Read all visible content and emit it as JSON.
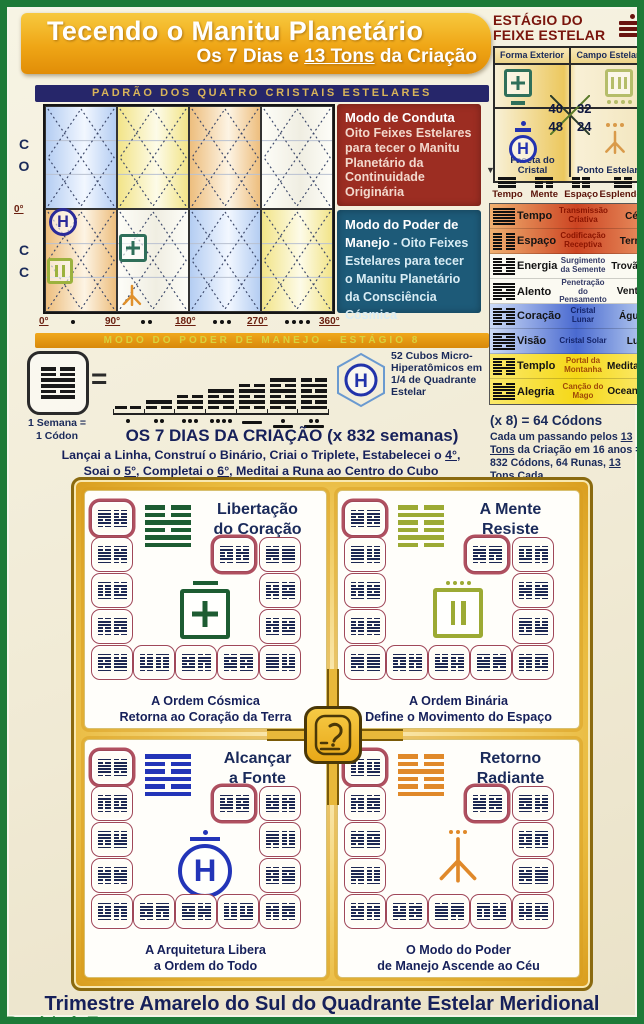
{
  "colors": {
    "frame_green": "#1d7a38",
    "banner_orange": "#efa616",
    "navy": "#16205a",
    "band_navy": "#26266a",
    "band_gold_text": "#d8b45a",
    "conduct_red": "#9c2d22",
    "power_blue": "#1d5a78",
    "gold_frame": "#e8b83a",
    "title_red": "#7a150d",
    "tile_border": "#a04858",
    "hexagram_navy": "#1c2752"
  },
  "icons": {
    "h_glyph": "H"
  },
  "header": {
    "title": "Tecendo o Manitu Planetário",
    "subtitle_pre": "Os 7 Dias e ",
    "subtitle_u": "13 Tons",
    "subtitle_post": " da Criação"
  },
  "stage_panel": {
    "title_line1": "ESTÁGIO DO",
    "title_line2": "FEIXE ESTELAR",
    "label_top_left": "Forma Exterior",
    "label_top_right": "Campo Estelar",
    "label_bottom_left": "Faceta do Cristal",
    "label_bottom_right": "Ponto Estelar",
    "num_top_left": "40",
    "num_top_right": "32",
    "num_bottom_left": "48",
    "num_bottom_right": "24",
    "symbol_colors": {
      "forma_exterior": "#2f6f5a",
      "campo_estelar": "#b5bd6a",
      "faceta_do_cristal": "#2433b0",
      "ponto_estelar": "#d99a4a"
    }
  },
  "pattern_chart": {
    "band_title": "PADRÃO DOS QUATRO CRISTAIS ESTELARES",
    "left_top_lines": [
      "C",
      "O"
    ],
    "left_zero": "0°",
    "left_bottom_lines": [
      "C",
      "C"
    ],
    "row1_cells": [
      "blue",
      "yellow",
      "orange",
      "white"
    ],
    "row2_cells": [
      "orange",
      "white",
      "blue",
      "yellow"
    ],
    "axis_labels": [
      "0°",
      "90°",
      "180°",
      "270°",
      "360°"
    ],
    "axis_dot_groups": [
      1,
      2,
      3,
      4
    ],
    "bottom_band": "MODO DO PODER DE MANEJO  -  ESTÁGIO 8",
    "symbol_colors": {
      "circle_h": "#2a2a99",
      "square_bars": "#9cb23e",
      "square_plus": "#2f6f5a",
      "trident": "#e0912c"
    }
  },
  "mode_boxes": {
    "conduct": {
      "heading": "Modo de Conduta",
      "body": "Oito Feixes Estelares para tecer o Manitu Planetário da Continuidade Originária"
    },
    "power": {
      "heading": "Modo do Poder de Manejo",
      "body": " - Oito Feixes Estelares para tecer o Manitu Planetário da Consciência Cósmica"
    }
  },
  "codon_table": {
    "headers": [
      "Tempo",
      "Mente",
      "Espaço",
      "Esplendor"
    ],
    "header_trigrams": [
      "sss",
      "sbb",
      "bbb",
      "bss"
    ],
    "rows": [
      {
        "hexagram": "ssssss",
        "name": "Tempo",
        "desc": "Transmissão Criativa",
        "element": "Céu",
        "theme": "red"
      },
      {
        "hexagram": "bbbbbb",
        "name": "Espaço",
        "desc": "Codificação Receptiva",
        "element": "Terra",
        "theme": "red"
      },
      {
        "hexagram": "bbsbbs",
        "name": "Energia",
        "desc": "Surgimento da Semente",
        "element": "Trovão",
        "theme": "white"
      },
      {
        "hexagram": "ssbssb",
        "name": "Alento",
        "desc": "Penetração do Pensamento",
        "element": "Vento",
        "theme": "white"
      },
      {
        "hexagram": "bsbbsb",
        "name": "Coração",
        "desc": "Cristal Lunar",
        "element": "Água",
        "theme": "blue"
      },
      {
        "hexagram": "sbssbs",
        "name": "Visão",
        "desc": "Cristal Solar",
        "element": "Luz",
        "theme": "blue"
      },
      {
        "hexagram": "sbbsbb",
        "name": "Templo",
        "desc": "Portal da Montanha",
        "element": "Meditação",
        "theme": "yellow"
      },
      {
        "hexagram": "bssbss",
        "name": "Alegria",
        "desc": "Canção do Mago",
        "element": "Oceano",
        "theme": "yellow"
      }
    ],
    "total_line": "(x 8) = 64 Códons",
    "note_p1": "Cada um passando pelos ",
    "note_u1": "13 Tons",
    "note_p2": " da Criação em 16 anos = 832 Códons, 64 Runas, ",
    "note_u2": "13 Tons",
    "note_p3": " Cada"
  },
  "creation_week": {
    "equation_label_line1": "1 Semana =",
    "equation_label_line2": "1 Códon",
    "codon_hexagram": "bbssbs",
    "equals_sign": "=",
    "day_stacks": [
      1,
      2,
      3,
      4,
      5,
      6,
      6
    ],
    "day_numerals": [
      1,
      2,
      3,
      4,
      5,
      6,
      7
    ],
    "cubes_label": "52 Cubos Micro-Hiperatômicos em 1/4 de Quadrante Estelar",
    "title": "OS 7 DIAS DA CRIAÇÃO (x 832 semanas)",
    "line1_pre": "Lançai a Linha, Construí o Binário, Criai o Triplete, Estabelecei o ",
    "line1_u": "4°",
    "line1_post": ",",
    "line2_pre": "Soai o ",
    "line2_u1": "5°",
    "line2_mid": ", Completai o ",
    "line2_u2": "6°",
    "line2_post": ", Meditai a Runa ao Centro do Cubo"
  },
  "quadrants": [
    {
      "title_line1": "Libertação",
      "title_line2": "do Coração",
      "caption_line1": "A Ordem Cósmica",
      "caption_line2": "Retorna ao Coração da Terra",
      "symbol": "square-plus",
      "color": "#1d5c32",
      "big_hexagram": "bbsbss"
    },
    {
      "title_line1": "A Mente",
      "title_line2": "Resiste",
      "caption_line1": "A Ordem Binária",
      "caption_line2": "Define o Movimento do Espaço",
      "symbol": "square-bars",
      "color": "#9caa34",
      "big_hexagram": "bsbbsb"
    },
    {
      "title_line1": "Alcançar",
      "title_line2": "a Fonte",
      "caption_line1": "A Arquitetura Libera",
      "caption_line2": "a Ordem do Todo",
      "symbol": "circle-h",
      "color": "#2335b8",
      "big_hexagram": "sbbsbs"
    },
    {
      "title_line1": "Retorno",
      "title_line2": "Radiante",
      "caption_line1": "O Modo do Poder",
      "caption_line2": "de Manejo Ascende ao Céu",
      "symbol": "trident",
      "color": "#e0892a",
      "big_hexagram": "bbsbbs"
    }
  ],
  "footer": {
    "line1": "Trimestre Amarelo do Sul do Quadrante Estelar Meridional",
    "line2_brand": "Domínio do Tempo",
    "line2_sep": " - ",
    "line2_rest": "Manitu Planetário da Consciência Cósmica se Completa - 2013 Geração do Cérebro Galáctico 1320"
  }
}
